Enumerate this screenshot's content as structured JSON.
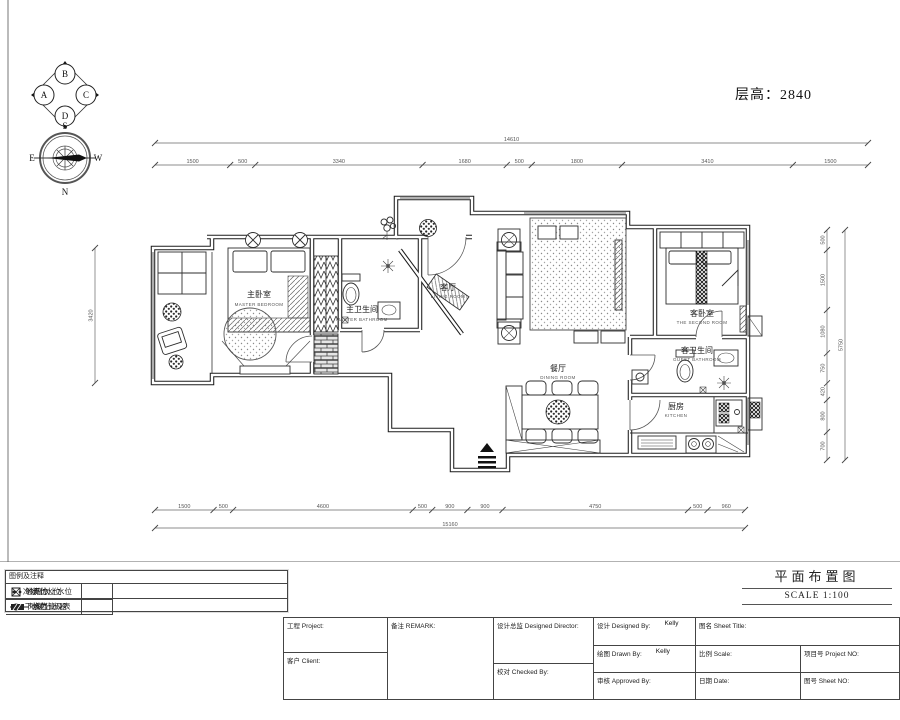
{
  "header": {
    "floor_height": "层高：2840"
  },
  "compass": {
    "a": "A",
    "b": "B",
    "c": "C",
    "d": "D",
    "n": "N",
    "s": "S",
    "e": "E",
    "w": "W"
  },
  "rooms": {
    "master_bedroom": {
      "cn": "主卧室",
      "en": "MASTER BEDROOM"
    },
    "master_bath": {
      "cn": "主卫生间",
      "en": "MASTER BATHROOM"
    },
    "living": {
      "cn": "客厅",
      "en": "LIVING ROOM"
    },
    "dining": {
      "cn": "餐厅",
      "en": "DINING ROOM"
    },
    "second_bedroom": {
      "cn": "客卧室",
      "en": "THE SECOND ROOM"
    },
    "guest_bath": {
      "cn": "客卫生间",
      "en": "GUEST BATHROOM"
    },
    "kitchen": {
      "cn": "厨房",
      "en": "KITCHEN"
    }
  },
  "dim_lines": [
    {
      "name": "top-overall",
      "x1": 155,
      "y1": 143,
      "x2": 868,
      "y2": 143,
      "labels": [
        "14610"
      ]
    },
    {
      "name": "top-segments",
      "x1": 155,
      "y1": 165,
      "x2": 868,
      "y2": 165,
      "labels": [
        "1500",
        "500",
        "3340",
        "1680",
        "500",
        "1800",
        "3410",
        "1500"
      ]
    },
    {
      "name": "bottom-segments",
      "x1": 155,
      "y1": 510,
      "x2": 745,
      "y2": 510,
      "labels": [
        "1500",
        "500",
        "4600",
        "500",
        "900",
        "900",
        "4750",
        "500",
        "960"
      ]
    },
    {
      "name": "bottom-overall",
      "x1": 155,
      "y1": 528,
      "x2": 745,
      "y2": 528,
      "labels": [
        "15160"
      ]
    },
    {
      "name": "left-overall",
      "x1": 95,
      "y1": 248,
      "x2": 95,
      "y2": 383,
      "labels": [
        "3420"
      ]
    },
    {
      "name": "right-segments",
      "x1": 827,
      "y1": 230,
      "x2": 827,
      "y2": 460,
      "labels": [
        "500",
        "1500",
        "1080",
        "750",
        "420",
        "800",
        "700"
      ]
    },
    {
      "name": "right-overall",
      "x1": 845,
      "y1": 230,
      "x2": 845,
      "y2": 460,
      "labels": [
        "5750"
      ]
    }
  ],
  "legend": {
    "title": "图例及注释",
    "items": [
      {
        "symbol": "floor-drain",
        "label": "地漏位"
      },
      {
        "symbol": "hot-cold-water",
        "label": "冷热水上水位"
      },
      {
        "symbol": "cold-water",
        "label": "冷水上水位"
      },
      {
        "symbol": "drain-outlet",
        "label": "下水位"
      },
      {
        "symbol": "gas-pipe-meter",
        "label": "燃气管及表"
      },
      {
        "symbol": "heating-manifold",
        "label": "地暖分水器"
      }
    ]
  },
  "plan_caption": {
    "title": "平面布置图",
    "scale": "SCALE 1:100"
  },
  "title_block": {
    "project_label": "工程 Project:",
    "client_label": "客户 Client:",
    "remark_label": "备注 REMARK:",
    "director_label": "设计总监 Designed Director:",
    "checked_label": "校对 Checked By:",
    "designed_label": "设计 Designed By:",
    "designed_value": "Kelly",
    "drawn_label": "绘图 Drawn By:",
    "drawn_value": "Kelly",
    "approved_label": "审核 Approved By:",
    "sheet_title_label": "图名 Sheet Title:",
    "scale_label": "比例 Scale:",
    "date_label": "日期 Date:",
    "project_no_label": "项目号 Project NO:",
    "sheet_no_label": "图号 Sheet NO:"
  }
}
